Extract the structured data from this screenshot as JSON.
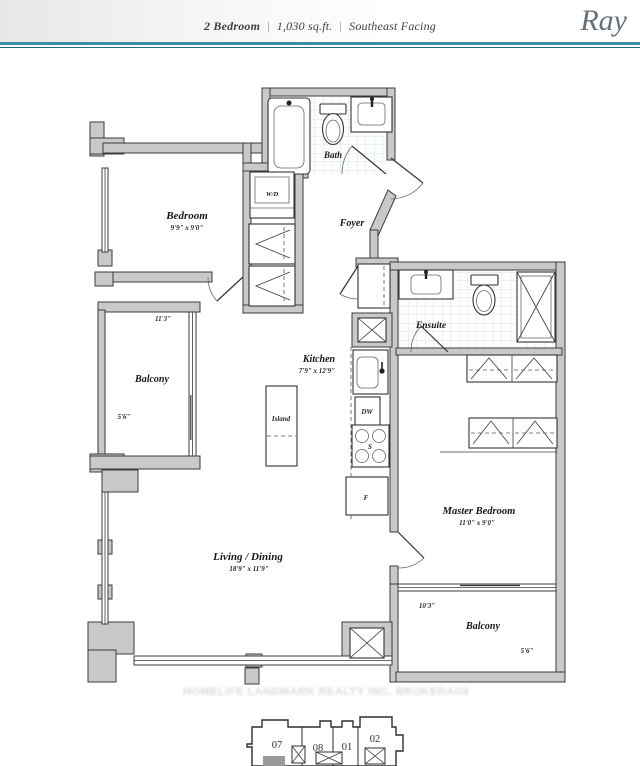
{
  "header": {
    "unit_type": "2 Bedroom",
    "separator": "|",
    "area": "1,030 sq.ft.",
    "facing": "Southeast Facing",
    "brand": "Ray"
  },
  "plan": {
    "rooms": {
      "bath": {
        "name": "Bath"
      },
      "bedroom": {
        "name": "Bedroom",
        "dims": "9'9\" x 9'0\""
      },
      "foyer": {
        "name": "Foyer"
      },
      "laundry": {
        "name": "W/D"
      },
      "balcony_left": {
        "name": "Balcony",
        "width": "11'3\"",
        "depth": "5'6\""
      },
      "kitchen": {
        "name": "Kitchen",
        "dims": "7'9\" x 12'9\""
      },
      "island": {
        "name": "Island"
      },
      "ensuite": {
        "name": "Ensuite"
      },
      "master_bedroom": {
        "name": "Master Bedroom",
        "dims": "11'0\" x 9'0\""
      },
      "living_dining": {
        "name": "Living / Dining",
        "dims": "18'9\" x 11'9\""
      },
      "balcony_right": {
        "name": "Balcony",
        "width": "10'3\"",
        "depth": "5'6\""
      }
    },
    "appliances": {
      "dishwasher": "DW",
      "fridge": "F",
      "stove": "S"
    }
  },
  "watermark": {
    "text": "HOMELIFE LANDMARK REALTY INC. BROKERAGE"
  },
  "keyplan": {
    "units": [
      "07",
      "08",
      "01",
      "02"
    ]
  },
  "colors": {
    "accent_top": "#3c8ea8",
    "accent_bottom": "#1f6d8b",
    "wall_fill": "#c9c9c9",
    "line": "#3b3b3b"
  }
}
